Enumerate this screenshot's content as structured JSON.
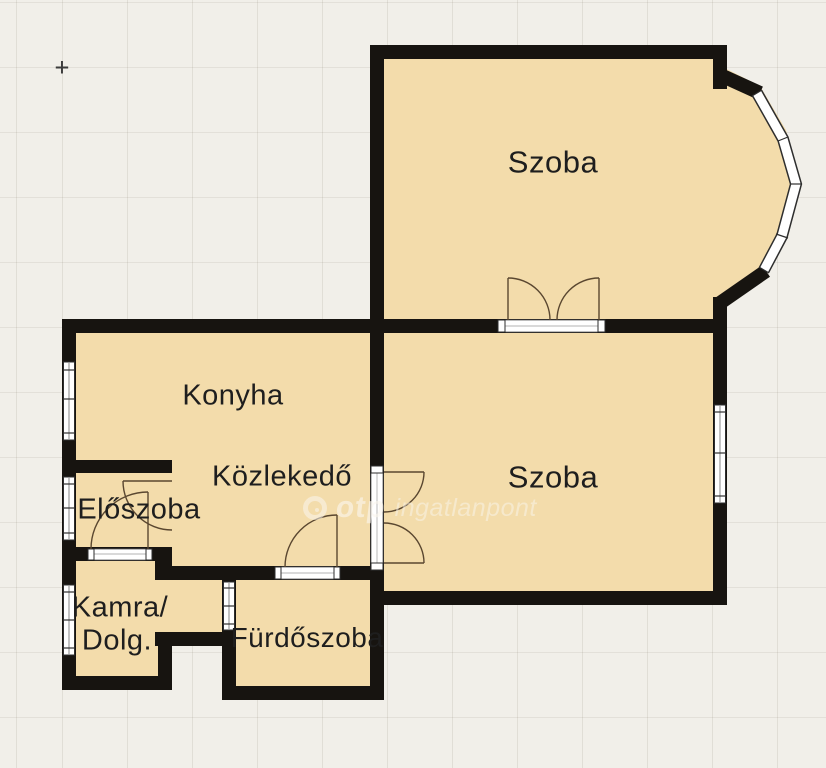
{
  "plan": {
    "kind": "apartment floor plan",
    "crosshair": "+",
    "rooms": {
      "szoba_top": {
        "label": "Szoba"
      },
      "szoba_right": {
        "label": "Szoba"
      },
      "konyha": {
        "label": "Konyha"
      },
      "kozlekedo": {
        "label": "Közlekedő"
      },
      "eloszoba": {
        "label": "Előszoba"
      },
      "kamra": {
        "line1": "Kamra/",
        "line2": "Dolg."
      },
      "furdoszoba": {
        "label": "Fürdőszoba"
      }
    },
    "watermark": {
      "brand": "otp",
      "suffix": "ingatlanpont"
    },
    "colors": {
      "background": "#f1efe9",
      "grid_line": "#e2dfd6",
      "room_fill": "#f3dcab",
      "wall": "#171410",
      "door_swing": "#5a4730",
      "window_frame": "#2e2e2e",
      "label_text": "#1e1e1e",
      "watermark_text": "rgba(250,246,238,0.6)"
    }
  }
}
